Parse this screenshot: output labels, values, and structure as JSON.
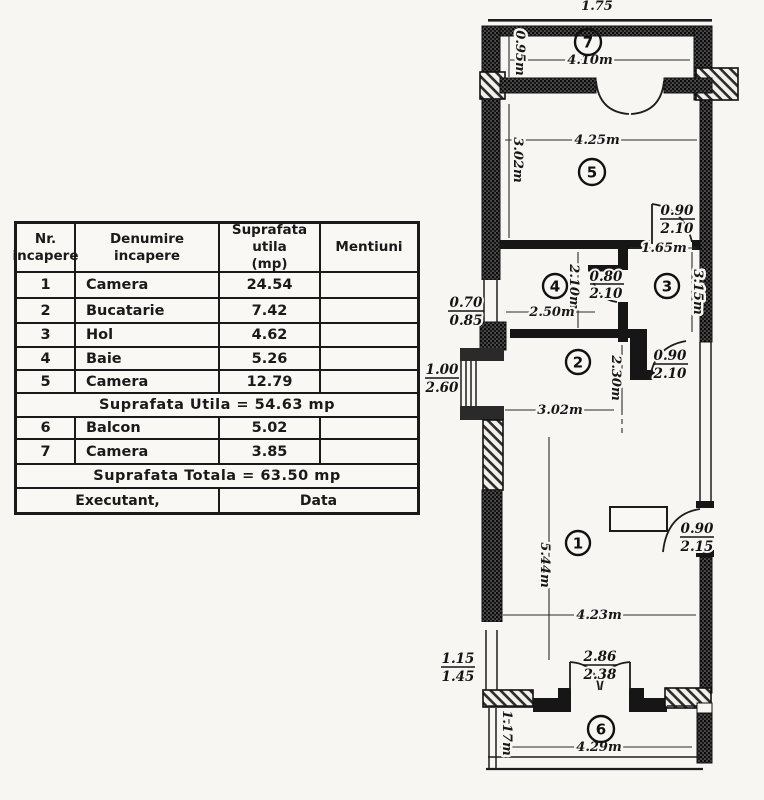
{
  "table": {
    "h1a": "Nr.",
    "h1b": "incapere",
    "h2a": "Denumire",
    "h2b": "incapere",
    "h3a": "Suprafata utila",
    "h3b": "(mp)",
    "h4": "Mentiuni",
    "rows": [
      {
        "nr": "1",
        "name": "Camera",
        "area": "24.54"
      },
      {
        "nr": "2",
        "name": "Bucatarie",
        "area": "7.42"
      },
      {
        "nr": "3",
        "name": "Hol",
        "area": "4.62"
      },
      {
        "nr": "4",
        "name": "Baie",
        "area": "5.26"
      },
      {
        "nr": "5",
        "name": "Camera",
        "area": "12.79"
      }
    ],
    "subtotal": "Suprafata Utila = 54.63 mp",
    "rows2": [
      {
        "nr": "6",
        "name": "Balcon",
        "area": "5.02"
      },
      {
        "nr": "7",
        "name": "Camera",
        "area": "3.85"
      }
    ],
    "total": "Suprafata Totala = 63.50 mp",
    "footer_left": "Executant,",
    "footer_right": "Data"
  },
  "plan": {
    "labels": {
      "top_dim": "1.75",
      "r7_num": "7",
      "r7_w": "4.10m",
      "r7_h": "0.95m",
      "r5_num": "5",
      "r5_w": "4.25m",
      "r5_h": "3.02m",
      "d53_a": "0.90",
      "d53_b": "2.10",
      "hall_w": "1.65m",
      "r4_num": "4",
      "r4_h": "2.10m",
      "r4_w": "2.50m",
      "d4_a": "0.80",
      "d4_b": "2.10",
      "r3_num": "3",
      "r3_h": "3.15m",
      "w070": "0.70",
      "w085": "0.85",
      "w100": "1.00",
      "w260": "2.60",
      "r2_num": "2",
      "r2_w": "3.02m",
      "r2_h": "2.30m",
      "d23_a": "0.90",
      "d23_b": "2.10",
      "r1_num": "1",
      "r1_h": "5.44m",
      "r1_w": "4.23m",
      "d1_a": "0.90",
      "d1_b": "2.15",
      "w115": "1.15",
      "w145": "1.45",
      "fd_a": "2.86",
      "fd_b": "2.38",
      "r6_num": "6",
      "r6_h": "1.17m",
      "r6_w": "4.29m"
    }
  }
}
